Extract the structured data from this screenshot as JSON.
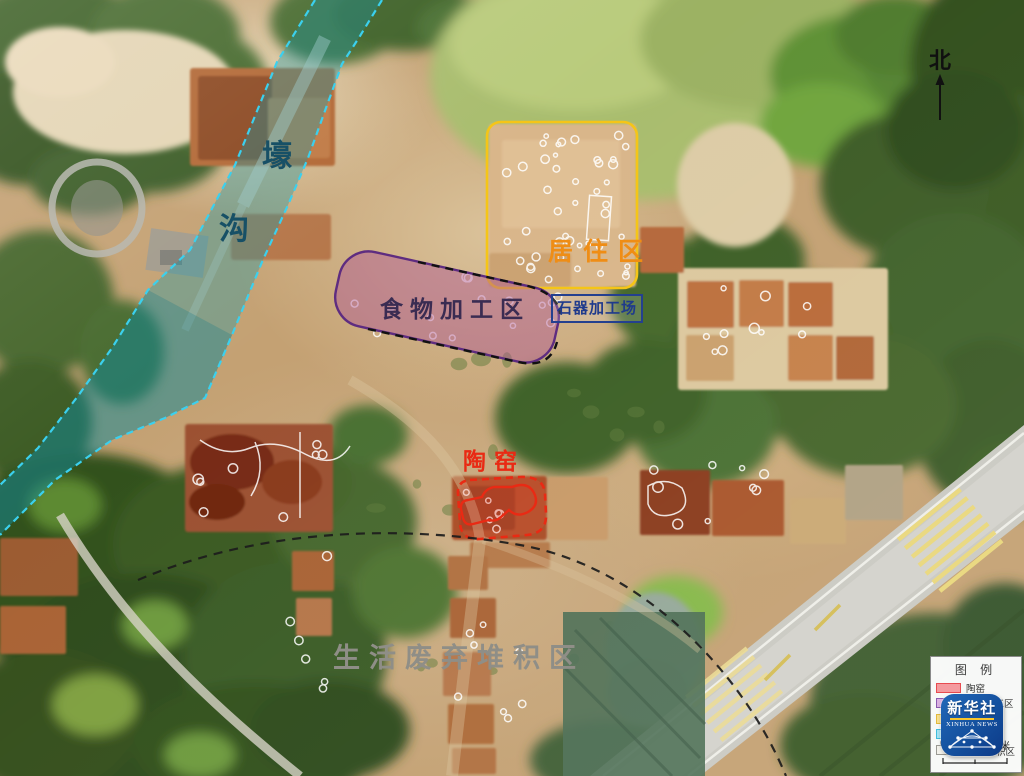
{
  "colors": {
    "moat_band": "rgba(21,153,170,0.36)",
    "moat_border": "#3bd0ee",
    "moat_label": "#175066",
    "res_border": "#f5c517",
    "res_label": "#ef8d15",
    "food_fill": "rgba(174,85,148,0.45)",
    "food_border": "#5e2c80",
    "food_label": "#3a2c52",
    "stone_label": "#1f3a8c",
    "kiln": "#e92a14",
    "waste_label": "#8f8e87",
    "arc": "#1c1c1c",
    "logo_bg": "#14509e",
    "logo_accent": "#f7c52d"
  },
  "annotations": {
    "moat_char1": "壕",
    "moat_char2": "沟",
    "residential": "居住区",
    "food": "食物加工区",
    "stone": "石器加工场",
    "kiln": "陶窑",
    "waste": "生活废弃堆积区",
    "north": "北"
  },
  "legend": {
    "title": "图 例",
    "entries": [
      {
        "label": "陶窑",
        "fill": "#f49a9e",
        "border": "#e84b50"
      },
      {
        "label": "食物加工区",
        "fill": "#dcb2e2",
        "border": "#8c5bb0"
      },
      {
        "label": "",
        "fill": "#f8e08f",
        "border": "#e3ba3e"
      },
      {
        "label": "",
        "fill": "#a6e3f2",
        "border": "#41bddc"
      },
      {
        "label": "积区",
        "fill": "#f2f1ea",
        "border": "#9a9a93"
      }
    ],
    "scale_start": "0",
    "scale_end": "5米"
  },
  "logo": {
    "cn": "新华社",
    "en": "XINHUA NEWS"
  }
}
